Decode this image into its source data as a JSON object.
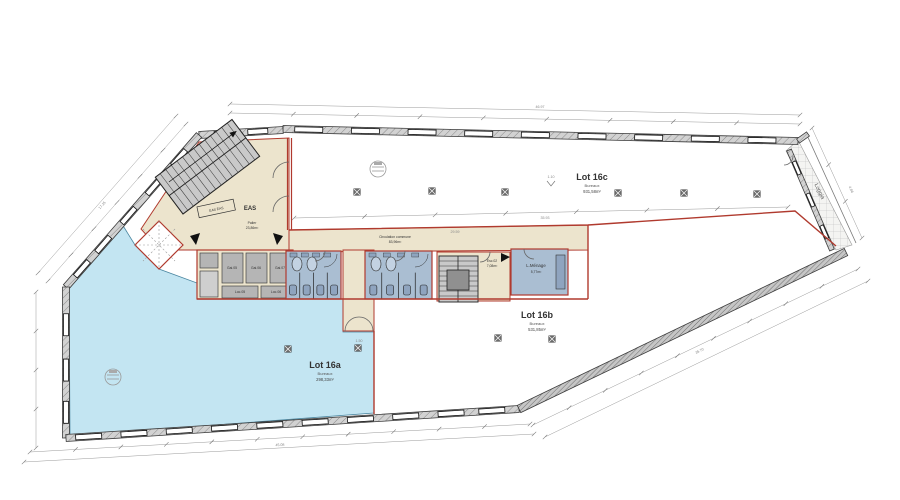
{
  "drawing": {
    "lots": {
      "lot_16a": {
        "name": "Lot 16a",
        "category": "Bureaux",
        "area": "298,33m²"
      },
      "lot_16b": {
        "name": "Lot 16b",
        "category": "Bureaux",
        "area": "531,85m²"
      },
      "lot_16c": {
        "name": "Lot 16c",
        "category": "Bureaux",
        "area": "931,58m²"
      }
    },
    "rooms": {
      "eas_box": "EAS EAS",
      "eas": "EAS",
      "palier": {
        "name": "Palier",
        "area": "23,86m²"
      },
      "circulation": {
        "name": "Circulation commune",
        "area": "83,96m²"
      },
      "menage": {
        "name": "L.Ménage",
        "area": "5,77m²"
      },
      "esc": {
        "name": "Esc.02",
        "area": "7,08m²"
      },
      "loggia": "Loggia",
      "cells": [
        "Gai.05",
        "Gai.06",
        "Gai.07",
        "Loc.05",
        "Loc.06"
      ]
    },
    "dims": {
      "top": "46.97",
      "top_inner": "35.93",
      "bottom": "45.08",
      "left": "17.25",
      "diag_right": "35.70",
      "loggia_w": "4.86",
      "corridor": "29.59",
      "stub": "1.50",
      "marker": "1.10"
    },
    "colors": {
      "lot_a_fill": "#c3e5f2",
      "circulation_fill": "#ece4cd",
      "sanitary_fill": "#aabed2",
      "wall_red": "#b03a2e",
      "room_gray": "#b5b5b5"
    }
  }
}
